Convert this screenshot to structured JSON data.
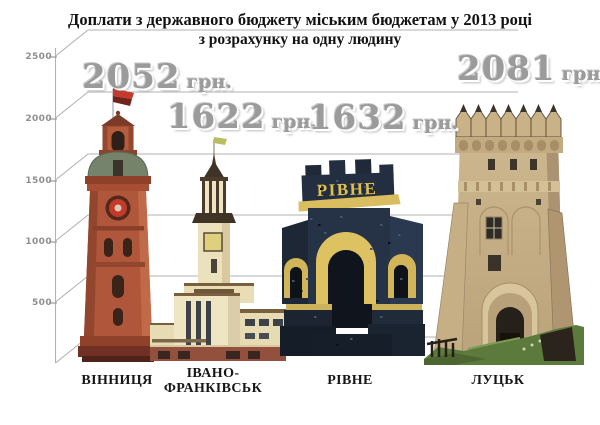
{
  "title": {
    "line1": "Доплати з державного бюджету міським бюджетам у 2013 році",
    "line2": "з розрахунку на одну людину"
  },
  "axis": {
    "ticks": [
      "2500",
      "2000",
      "1500",
      "1000",
      "500"
    ]
  },
  "cities": [
    {
      "name": "ВІННИЦЯ",
      "value": "2052",
      "unit": "грн.",
      "landmark": "red-brick water tower with green dome and red flag"
    },
    {
      "name": "ІВАНО-ФРАНКІВСЬК",
      "label_lines": [
        "ІВАНО-",
        "ФРАНКІВСЬК"
      ],
      "value": "1622",
      "unit": "грн.",
      "landmark": "cream art-deco city hall tower with clock"
    },
    {
      "name": "РІВНЕ",
      "value": "1632",
      "unit": "грн.",
      "monument_text": "РІВНЕ",
      "landmark": "dark stone city-entrance arch monument with yellow lettering"
    },
    {
      "name": "ЛУЦЬК",
      "value": "2081",
      "unit": "грн.",
      "landmark": "tan stone Lubart castle gate tower on grassy mound"
    }
  ],
  "palette": {
    "background": "#ffffff",
    "grid_gray": "#b0b0b0",
    "value_text_gray": "#9b9b9b",
    "title_black": "#121212",
    "vinnytsia_brick": "#b0563a",
    "vinnytsia_dome_green": "#75836a",
    "flag_red": "#c63a2e",
    "frankivsk_cream": "#efe5c2",
    "frankivsk_brown": "#6e5638",
    "rivne_navy": "#232f40",
    "rivne_yellow": "#dec160",
    "lutsk_tan": "#cdb78f",
    "grass_green": "#5d7a3d"
  },
  "chart_data": {
    "type": "bar",
    "style": "pictorial-infographic (city landmark photos as bars)",
    "title": "Доплати з державного бюджету міським бюджетам у 2013 році з розрахунку на одну людину",
    "categories": [
      "Вінниця",
      "Івано-Франківськ",
      "Рівне",
      "Луцьк"
    ],
    "values": [
      2052,
      1622,
      1632,
      2081
    ],
    "unit": "грн.",
    "ylabel": "",
    "xlabel": "",
    "ylim": [
      0,
      2500
    ],
    "ytick_interval": 500,
    "yticks": [
      500,
      1000,
      1500,
      2000,
      2500
    ],
    "grid": true,
    "grid_style": "oblique 3D-perspective gridlines from left axis",
    "legend": "none",
    "data_labels": [
      "2052 грн.",
      "1622 грн.",
      "1632 грн.",
      "2081 грн."
    ]
  }
}
